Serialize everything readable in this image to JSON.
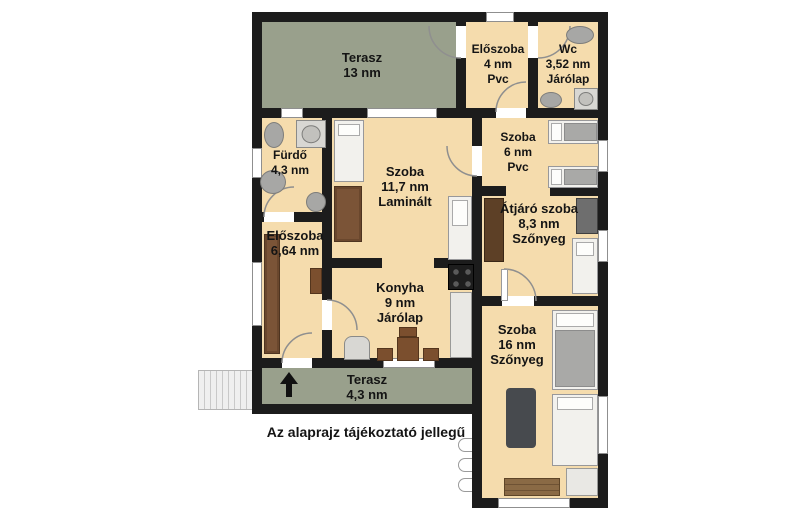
{
  "caption": "Az alaprajz tájékoztató jellegű",
  "colors": {
    "wall": "#1c1c1c",
    "terrace_floor": "#99a08c",
    "interior_floor": "#f5dcad",
    "background": "#ffffff"
  },
  "rooms": {
    "terasz13": {
      "name": "Terasz",
      "area": "13 nm"
    },
    "eloszoba4": {
      "name": "Előszoba",
      "area": "4 nm",
      "floor": "Pvc"
    },
    "wc": {
      "name": "Wc",
      "area": "3,52 nm",
      "floor": "Járólap"
    },
    "furdo": {
      "name": "Fürdő",
      "area": "4,3 nm"
    },
    "szoba117": {
      "name": "Szoba",
      "area": "11,7 nm",
      "floor": "Laminált"
    },
    "szoba6": {
      "name": "Szoba",
      "area": "6 nm",
      "floor": "Pvc"
    },
    "atjaro": {
      "name": "Átjáró szoba",
      "area": "8,3 nm",
      "floor": "Szőnyeg"
    },
    "eloszoba664": {
      "name": "Előszoba",
      "area": "6,64 nm"
    },
    "konyha": {
      "name": "Konyha",
      "area": "9 nm",
      "floor": "Járólap"
    },
    "szoba16": {
      "name": "Szoba",
      "area": "16 nm",
      "floor": "Szőnyeg"
    },
    "terasz43": {
      "name": "Terasz",
      "area": "4,3 nm"
    }
  }
}
